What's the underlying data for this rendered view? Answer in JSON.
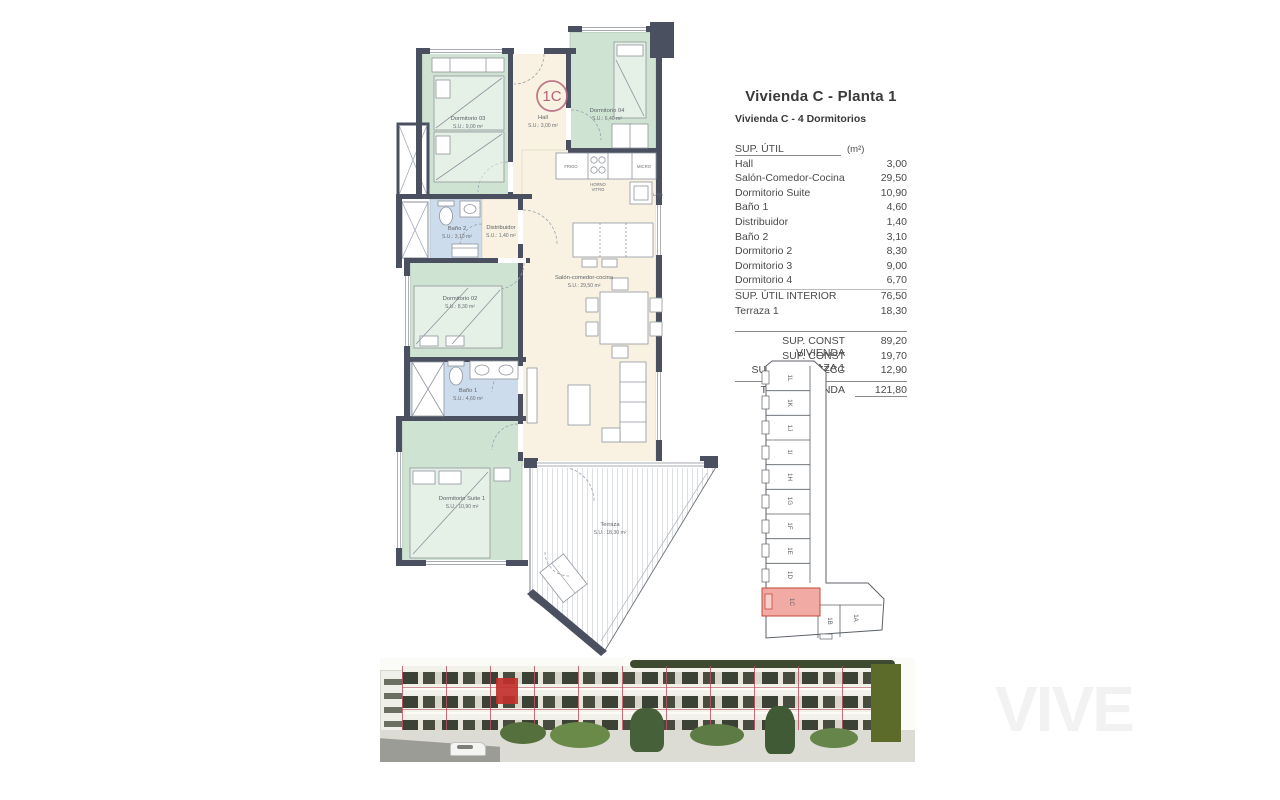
{
  "panel": {
    "title": "Vivienda C - Planta 1",
    "subtitle": "Vivienda C - 4 Dormitorios",
    "table": {
      "header_label": "SUP. ÚTIL",
      "header_unit": "(m²)",
      "rows": [
        {
          "label": "Hall",
          "value": "3,00"
        },
        {
          "label": "Salón-Comedor-Cocina",
          "value": "29,50"
        },
        {
          "label": "Dormitorio Suite",
          "value": "10,90"
        },
        {
          "label": "Baño 1",
          "value": "4,60"
        },
        {
          "label": "Distribuidor",
          "value": "1,40"
        },
        {
          "label": "Baño 2",
          "value": "3,10"
        },
        {
          "label": "Dormitorio 2",
          "value": "8,30"
        },
        {
          "label": "Dormitorio 3",
          "value": "9,00"
        },
        {
          "label": "Dormitorio 4",
          "value": "6,70"
        },
        {
          "label": "SUP. ÚTIL INTERIOR",
          "value": "76,50"
        },
        {
          "label": "Terraza 1",
          "value": "18,30"
        }
      ],
      "summary": [
        {
          "label": "SUP. CONST VIVIENDA",
          "value": "89,20"
        },
        {
          "label": "SUP. CONST TERRAZA 1",
          "value": "19,70"
        },
        {
          "label": "SUP. CONST ZZCC",
          "value": "12,90"
        }
      ],
      "total": {
        "label": "TOTAL VIVIENDA",
        "value": "121,80"
      }
    }
  },
  "floorplan": {
    "unit_badge": "1C",
    "rooms": [
      {
        "name": "Dormitorio 03",
        "area": "S.U.: 9,00 m²"
      },
      {
        "name": "Hall",
        "area": "S.U.: 3,00 m²"
      },
      {
        "name": "Dormitorio 04",
        "area": "S.U.: 6,40 m²"
      },
      {
        "name": "Baño 2",
        "area": "S.U.: 3,10 m²"
      },
      {
        "name": "Distribuidor",
        "area": "S.U.: 1,40 m²"
      },
      {
        "name": "Dormitorio 02",
        "area": "S.U.: 8,30 m²"
      },
      {
        "name": "Salón-comedor-cocina",
        "area": "S.U.: 29,50 m²"
      },
      {
        "name": "Baño 1",
        "area": "S.U.: 4,60 m²"
      },
      {
        "name": "Dormitorio Suite 1",
        "area": "S.U.: 10,90 m²"
      },
      {
        "name": "Terraza",
        "area": "S.U.: 18,30 m²"
      }
    ],
    "kitchen_labels": {
      "frigo": "FRIGO",
      "micro": "MICRO",
      "horno_line1": "HORNO",
      "horno_line2": "VITRO",
      "lava": "LAVA"
    }
  },
  "keyplan": {
    "highlighted": "1C",
    "units": [
      "1L",
      "1K",
      "1J",
      "1I",
      "1H",
      "1G",
      "1F",
      "1E",
      "1D",
      "1C",
      "1B",
      "1A"
    ]
  },
  "watermark": "VIVE",
  "colors": {
    "wall": "#4a5060",
    "bedroom_fill": "#cfe3d3",
    "living_fill": "#f9f2e2",
    "bath_fill": "#cddcec",
    "keyplan_highlight": "#f2aba4",
    "badge_accent": "#b4657a",
    "grid_pink": "#bd5263",
    "highlight_red": "#c2302a"
  }
}
